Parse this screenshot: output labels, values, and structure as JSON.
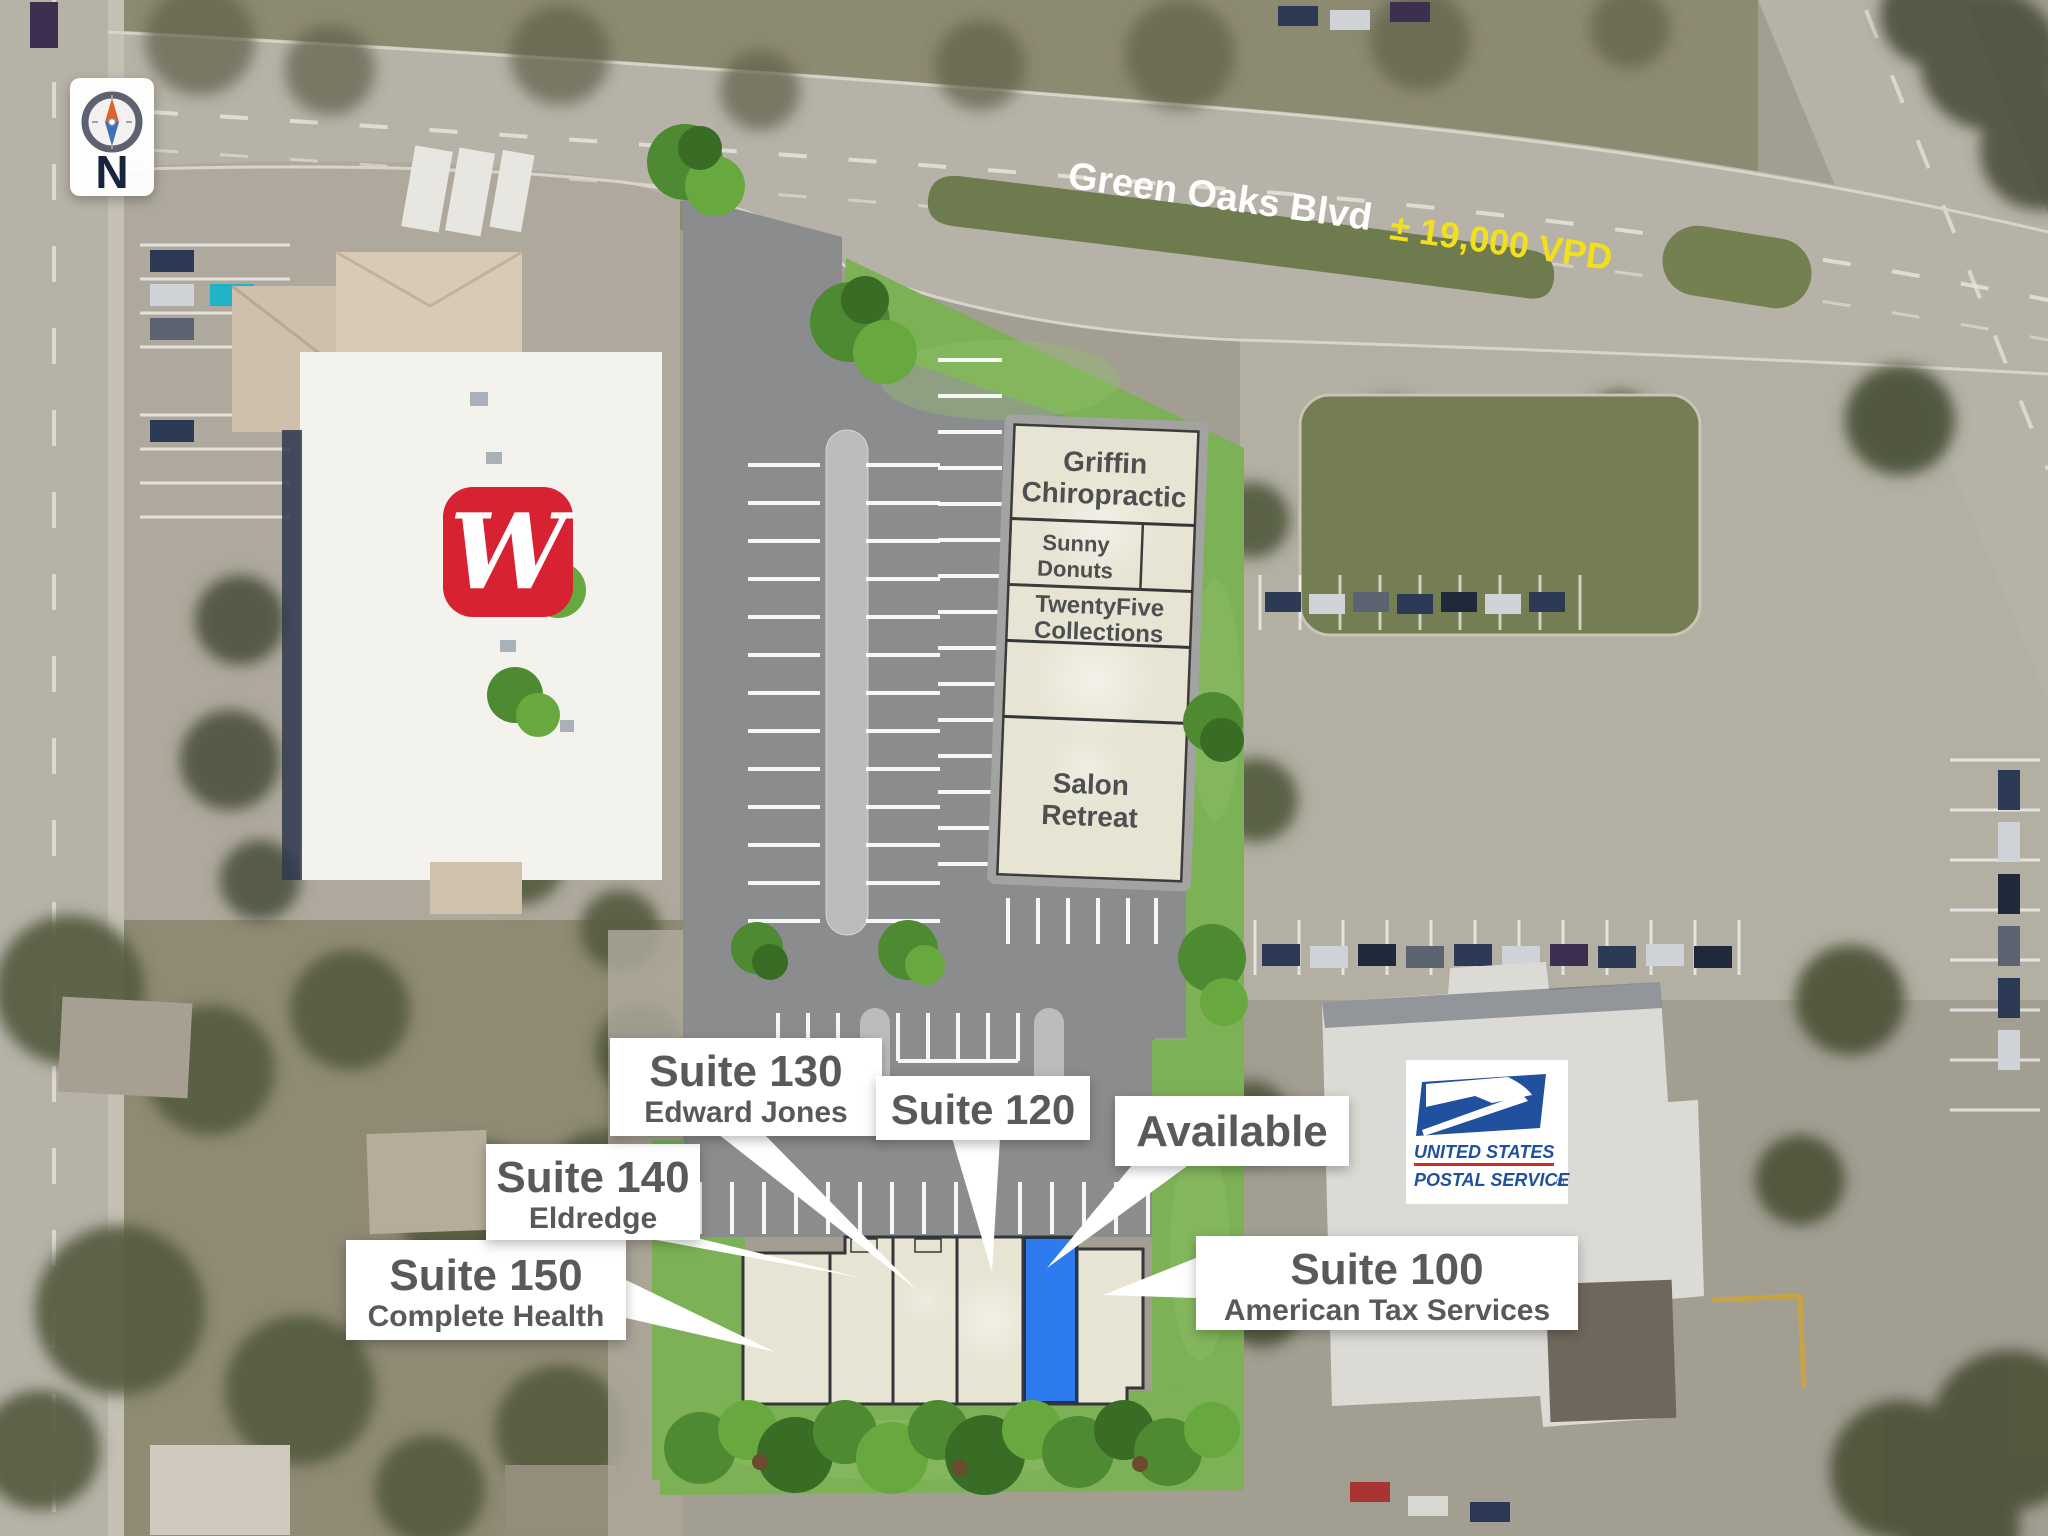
{
  "compass": {
    "north": "N"
  },
  "street": {
    "name": "Green Oaks Blvd",
    "traffic": "± 19,000 VPD"
  },
  "brands": {
    "walgreens_monogram": "W",
    "usps": {
      "line1": "UNITED STATES",
      "line2": "POSTAL SERVICE",
      "registered": "®"
    }
  },
  "tenant_building": {
    "units": [
      {
        "line1": "Griffin",
        "line2": "Chiropractic"
      },
      {
        "line1": "Sunny",
        "line2": "Donuts"
      },
      {
        "line1": "TwentyFive",
        "line2": "Collections"
      },
      {
        "line1": "Salon",
        "line2": "Retreat"
      }
    ]
  },
  "suite_callouts": [
    {
      "suite": "Suite 150",
      "tenant": "Complete Health"
    },
    {
      "suite": "Suite 140",
      "tenant": "Eldredge"
    },
    {
      "suite": "Suite 130",
      "tenant": "Edward Jones"
    },
    {
      "suite": "Suite 120",
      "tenant": ""
    },
    {
      "suite": "Available",
      "tenant": ""
    },
    {
      "suite": "Suite 100",
      "tenant": "American Tax Services"
    }
  ],
  "colors": {
    "available_suite": "#2e7bf0",
    "callout_text": "#58595b",
    "traffic_text": "#f2df1d",
    "walgreens_red": "#d92231",
    "usps_blue": "#21509e",
    "overlay_asphalt": "#8a8c8e",
    "overlay_grass": "#7cb155",
    "building_fill": "#e7e4d3"
  }
}
